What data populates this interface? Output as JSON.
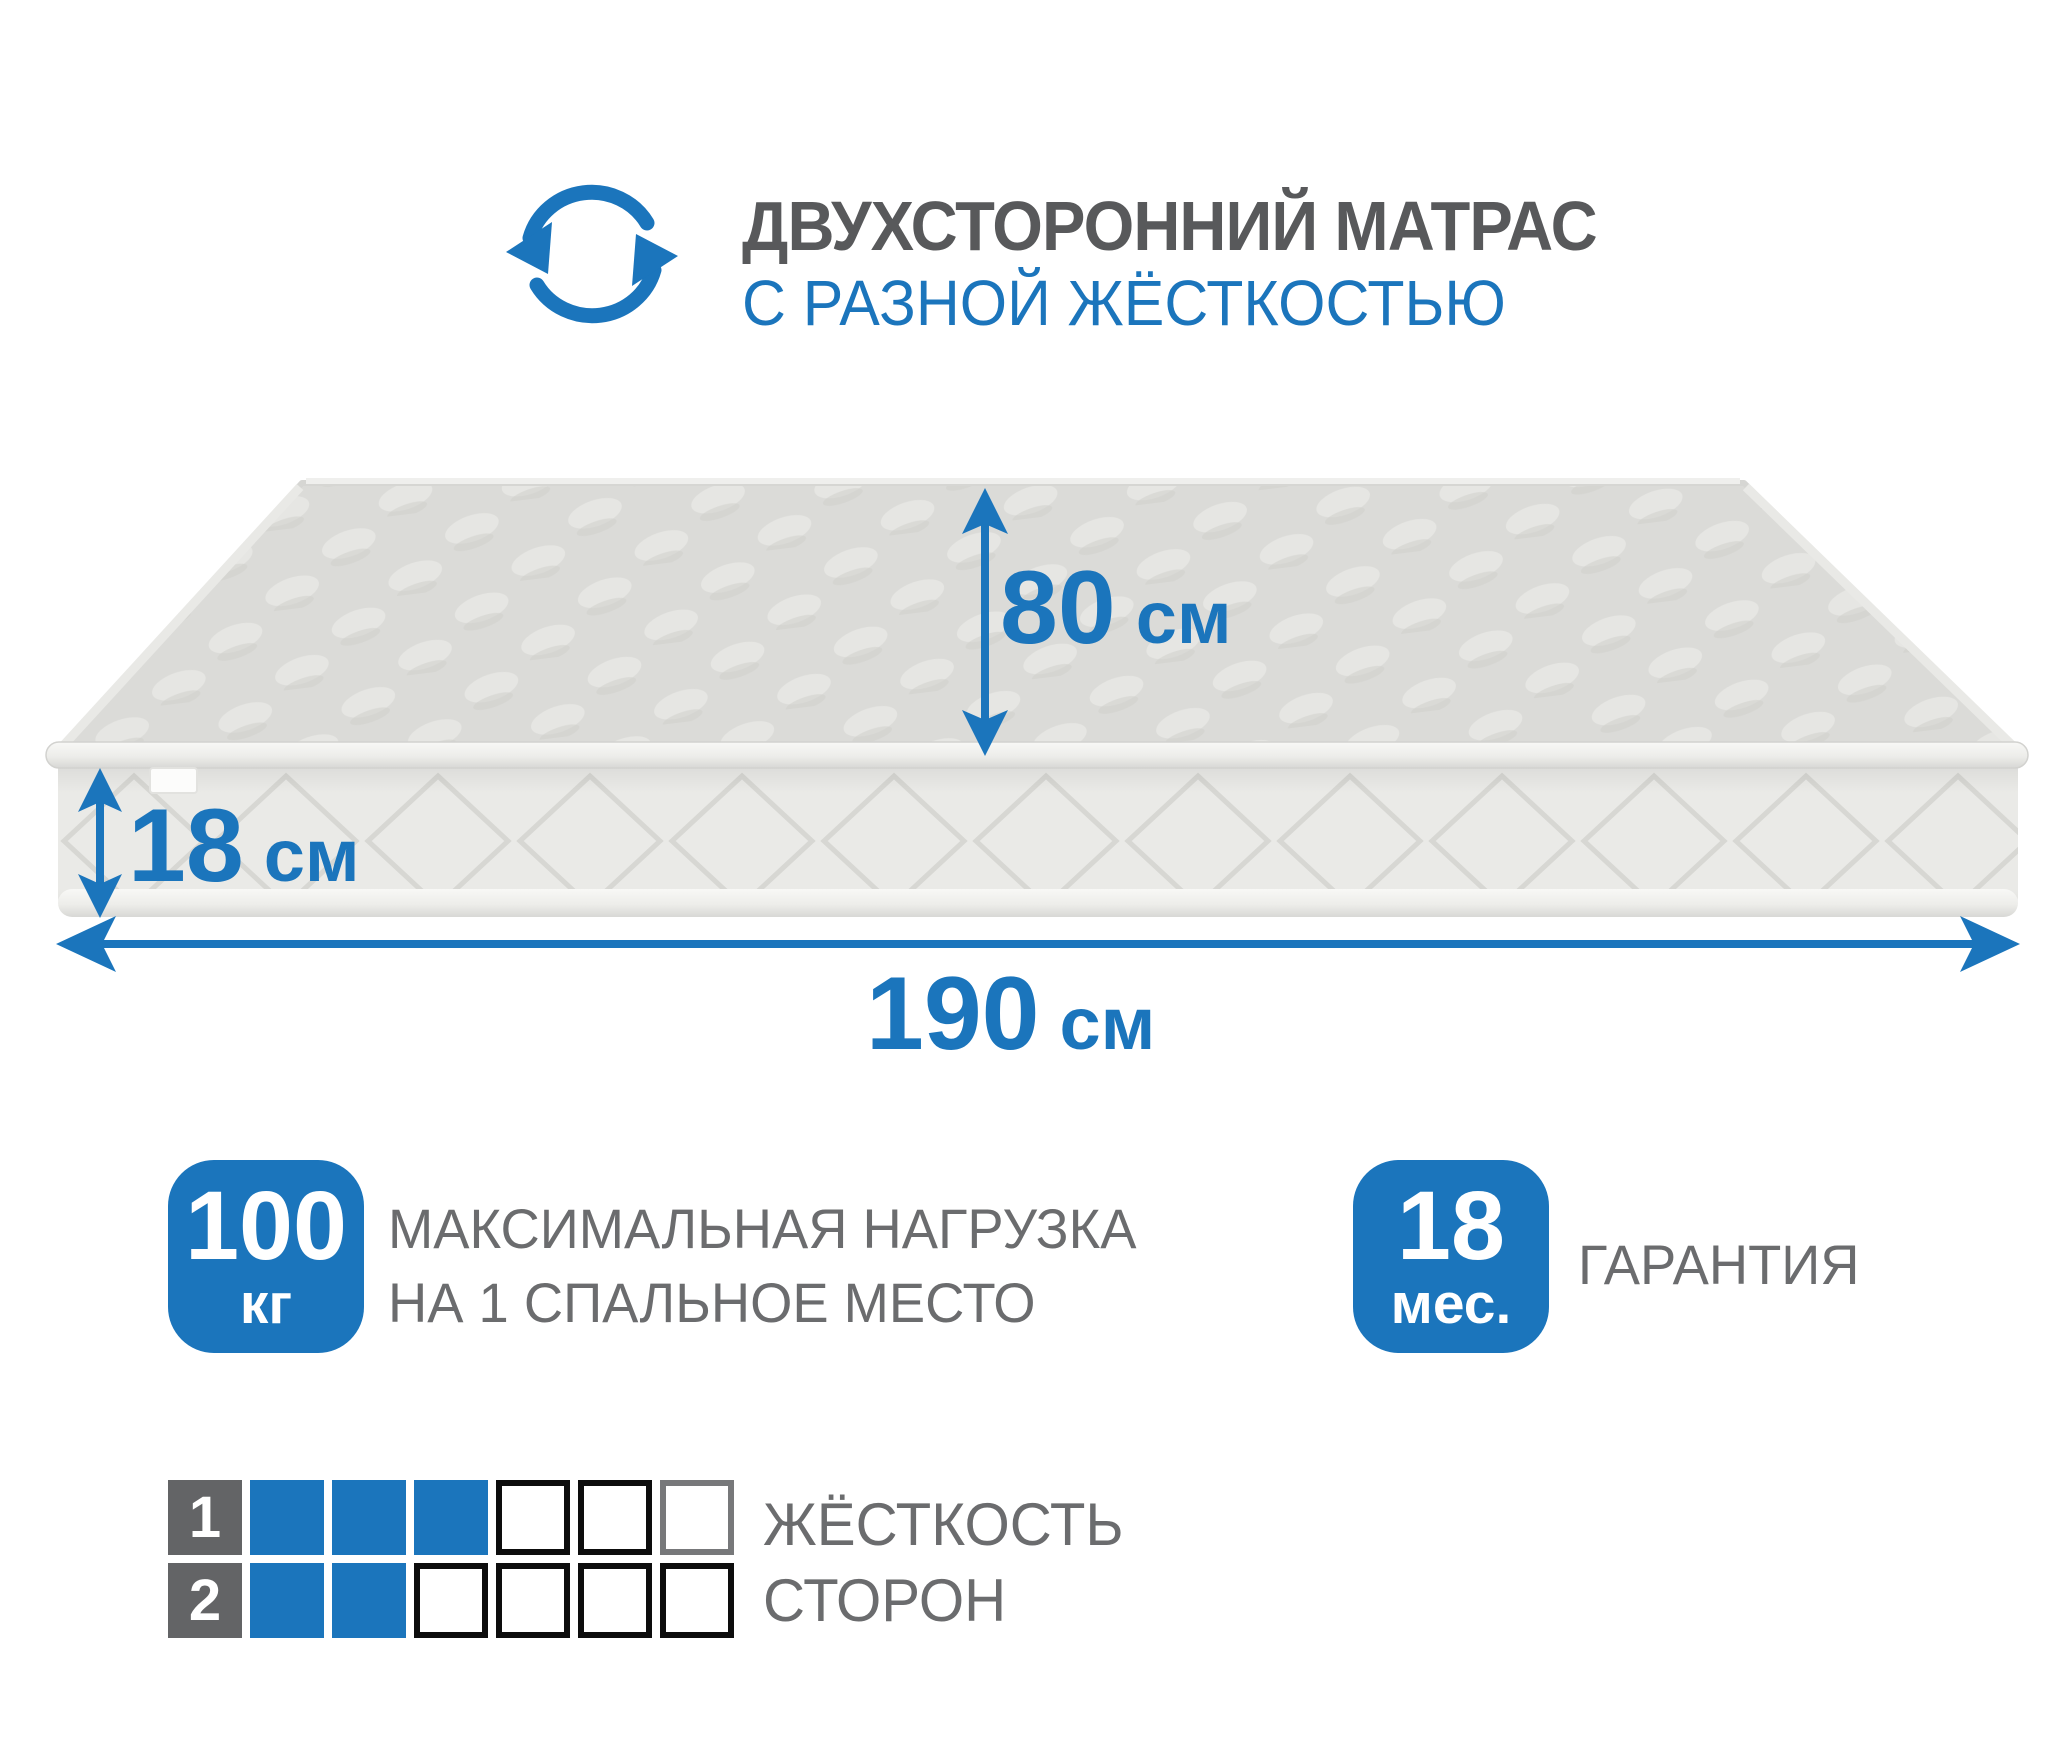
{
  "colors": {
    "blue": "#1B75BC",
    "title_gray": "#58595B",
    "text_gray": "#6B6C6E",
    "cell_dark": "#636466",
    "cell_border": "#0D0D0D",
    "cell_border_gray": "#77787A",
    "mattress_top": "#DBDBD8",
    "mattress_side": "#EAEAE7"
  },
  "header": {
    "title": "ДВУХСТОРОННИЙ МАТРАС",
    "subtitle": "С РАЗНОЙ ЖЁСТКОСТЬЮ",
    "icon": "rotate-arrows-icon"
  },
  "dimensions": {
    "depth": {
      "value": "80",
      "unit": "см"
    },
    "thickness": {
      "value": "18",
      "unit": "см"
    },
    "width": {
      "value": "190",
      "unit": "см"
    }
  },
  "badges": {
    "load": {
      "value": "100",
      "unit": "кг",
      "label_line1": "МАКСИМАЛЬНАЯ НАГРУЗКА",
      "label_line2": "НА 1 СПАЛЬНОЕ МЕСТО"
    },
    "warranty": {
      "value": "18",
      "unit": "мес.",
      "label": "ГАРАНТИЯ"
    }
  },
  "hardness_scale": {
    "label_line1": "ЖЁСТКОСТЬ",
    "label_line2": "СТОРОН",
    "max": 6,
    "rows": [
      {
        "index": "1",
        "filled": 3,
        "last_cell_border": "gray"
      },
      {
        "index": "2",
        "filled": 2,
        "last_cell_border": "black"
      }
    ]
  }
}
